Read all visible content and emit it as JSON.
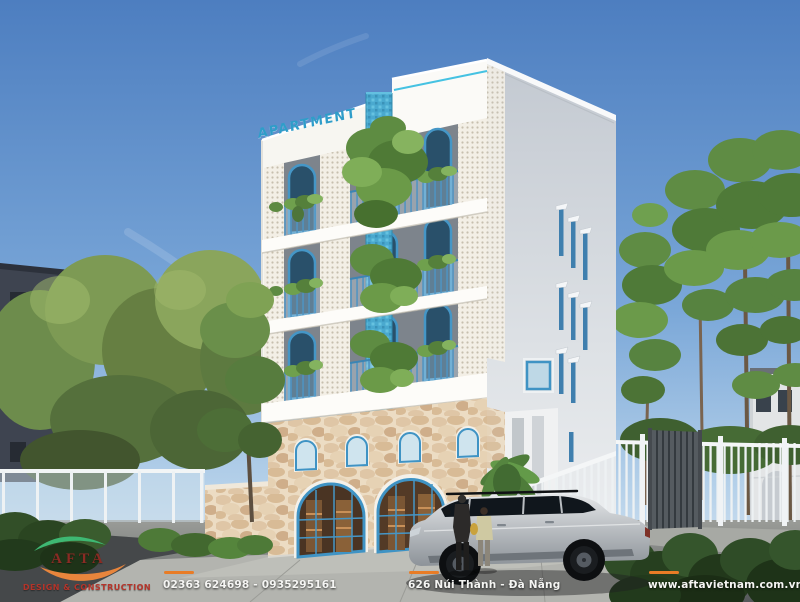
{
  "sign": {
    "label": "APARTMENT"
  },
  "logo": {
    "name": "AFTA",
    "tagline": "DESIGN & CONSTRUCTION"
  },
  "footer": {
    "phone": "02363 624698 - 0935295161",
    "address": "626 Núi Thành - Đà Nẵng",
    "website": "www.aftavietnam.com.vn"
  },
  "colors": {
    "accent_blue": "#3f93c4",
    "mosaic_teal": "#4aa9cf",
    "orange_dash": "#e87c26",
    "logo_green": "#3eb873",
    "logo_orange": "#e8853c",
    "logo_red": "#a32e26",
    "sky": "#5d8cc7",
    "stone": "#ecdcc3",
    "foliage": "#5c8a42",
    "car_silver": "#babec2"
  }
}
